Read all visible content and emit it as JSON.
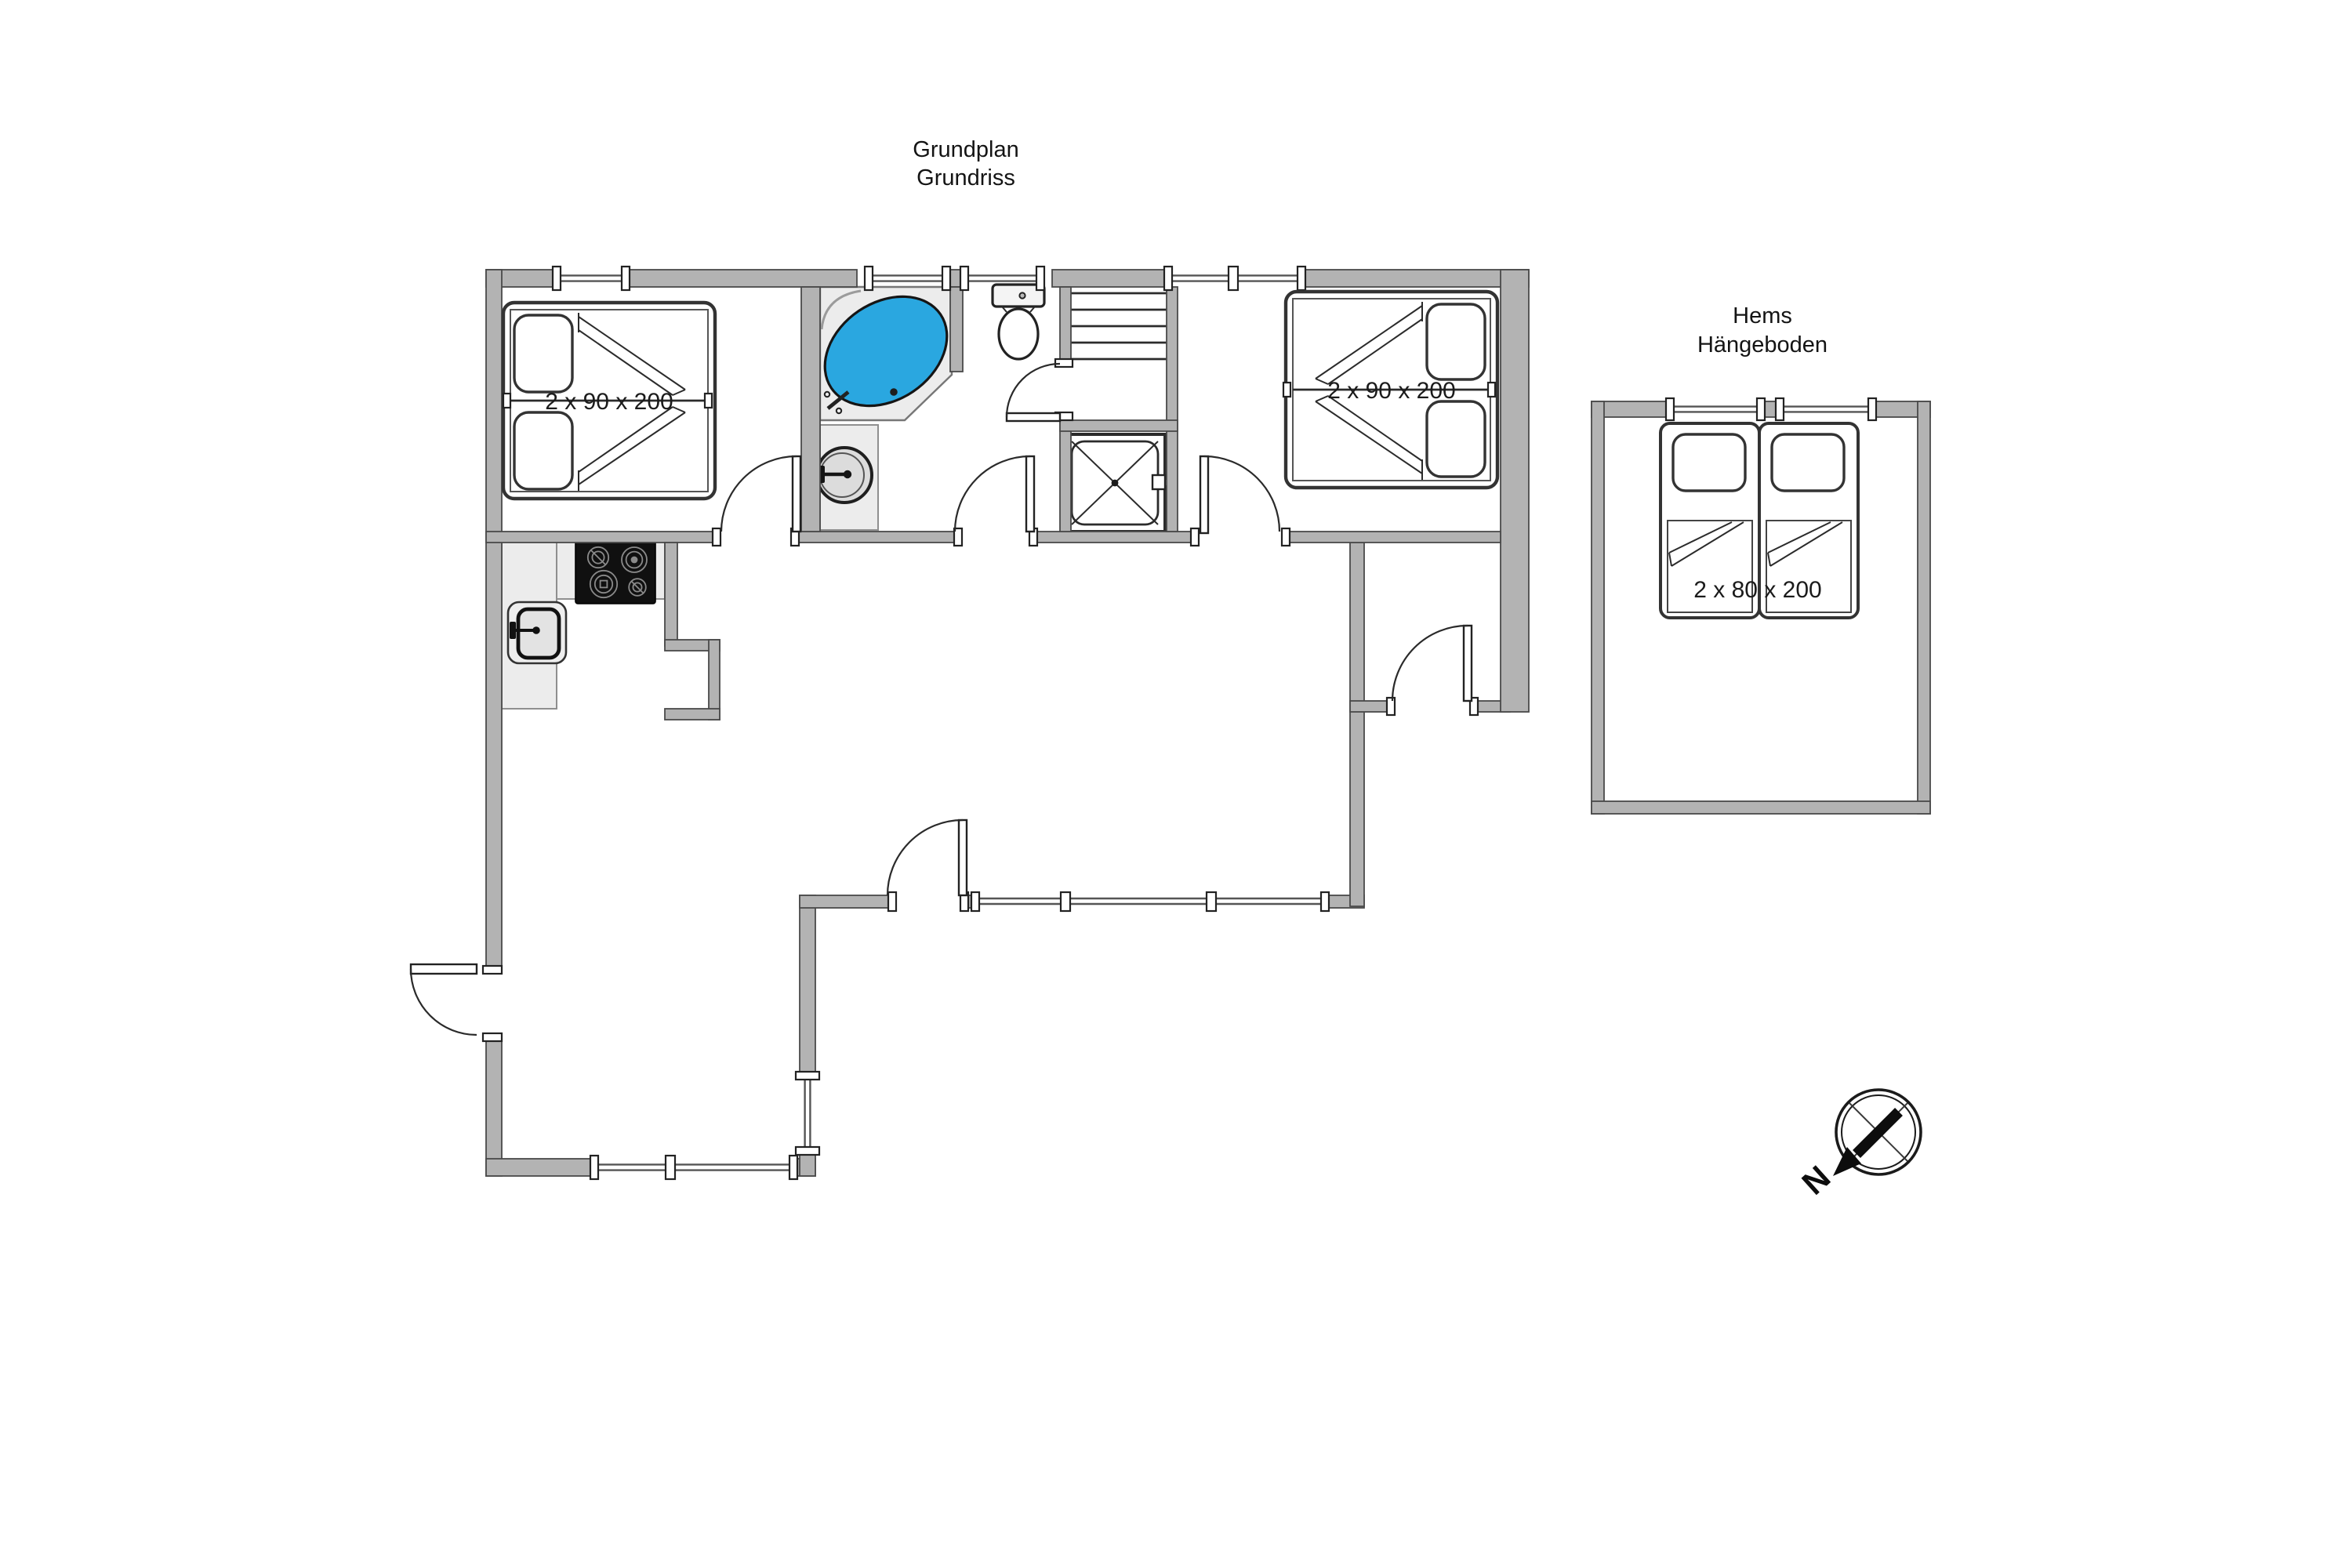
{
  "title": {
    "line1": "Grundplan",
    "line2": "Grundriss"
  },
  "loft_title": {
    "line1": "Hems",
    "line2": "Hängeboden"
  },
  "bed_labels": {
    "bedroom_left": "2 x 90 x 200",
    "bedroom_right": "2 x 90 x 200",
    "loft": "2 x 80 x 200"
  },
  "compass": {
    "north": "N"
  },
  "colors": {
    "wall": "#b3b3b3",
    "wall_outline": "#4a4a4a",
    "counter": "#ececec",
    "tub_water": "#2aa7e0",
    "stove": "#101010",
    "line": "#2b2b2b",
    "window_line": "#555555",
    "label_text": "#1b1b1b"
  }
}
